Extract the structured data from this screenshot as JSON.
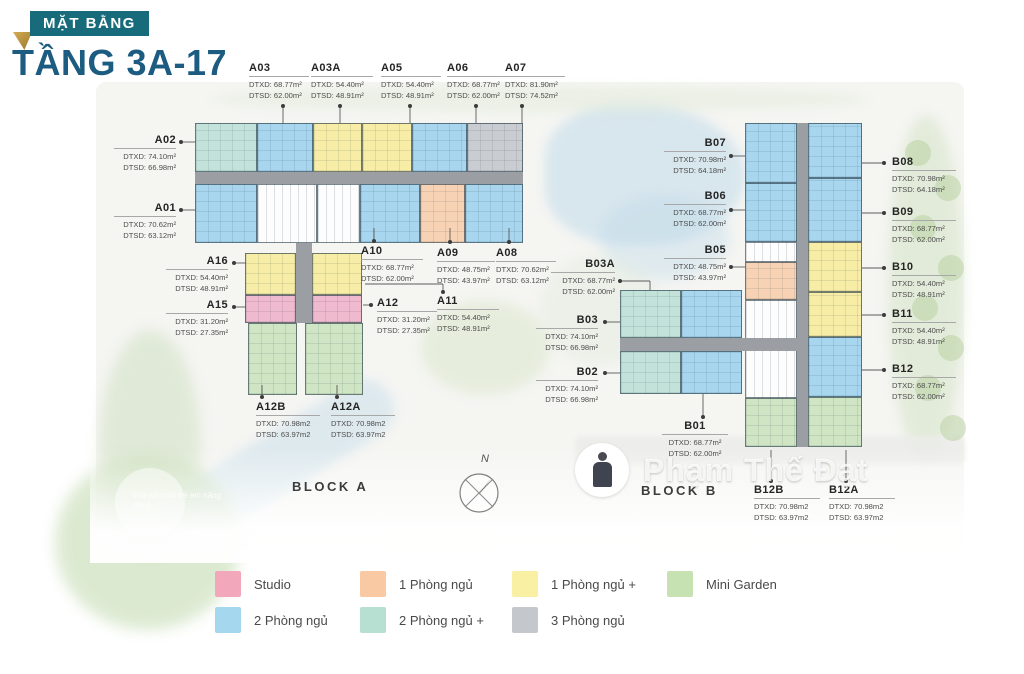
{
  "title": {
    "badge": "MẶT BẰNG",
    "heading": "TẦNG 3A-17"
  },
  "block_a_label": "BLOCK A",
  "block_b_label": "BLOCK B",
  "compass_label": "N",
  "watermark": {
    "name": "Phạm Thế Đạt"
  },
  "background_note": "khu vui chơi trẻ em năng động",
  "accent": {
    "badge_bg": "#186b7b",
    "heading_color": "#1b5c80",
    "fold_gold": "#c19b42"
  },
  "palette": {
    "blue": "#a7d6ee",
    "teal": "#c3e3da",
    "yellow": "#f7eda6",
    "peach": "#f7d2b4",
    "pink": "#efb9ce",
    "green": "#cfe5c4",
    "gray": "#c9ccd1",
    "core": "#fdfdfd",
    "corridor": "#9b9fa3"
  },
  "legend": [
    {
      "label": "Studio",
      "color": "#f2a7bb",
      "row": 0,
      "col": 0
    },
    {
      "label": "1 Phòng ngủ",
      "color": "#f9c9a4",
      "row": 0,
      "col": 1
    },
    {
      "label": "1 Phòng ngủ +",
      "color": "#f9f0a3",
      "row": 0,
      "col": 2
    },
    {
      "label": "Mini Garden",
      "color": "#c6e2b2",
      "row": 0,
      "col": 3
    },
    {
      "label": "2 Phòng ngủ",
      "color": "#a5d8ef",
      "row": 1,
      "col": 0
    },
    {
      "label": "2 Phòng ngủ +",
      "color": "#b8e0d2",
      "row": 1,
      "col": 1
    },
    {
      "label": "3 Phòng ngủ",
      "color": "#c4c7cc",
      "row": 1,
      "col": 2
    }
  ],
  "units": [
    {
      "id": "A03",
      "dtxd": "DTXD: 68.77m²",
      "dtsd": "DTSD: 62.00m²",
      "x": 249,
      "y": 62,
      "w": 60,
      "align": "left",
      "dot": [
        283,
        106
      ],
      "segs": [
        [
          283,
          106,
          283,
          123
        ]
      ]
    },
    {
      "id": "A03A",
      "dtxd": "DTXD: 54.40m²",
      "dtsd": "DTSD: 48.91m²",
      "x": 311,
      "y": 62,
      "w": 62,
      "align": "left",
      "dot": [
        340,
        106
      ],
      "segs": [
        [
          340,
          106,
          340,
          123
        ]
      ]
    },
    {
      "id": "A05",
      "dtxd": "DTXD: 54.40m²",
      "dtsd": "DTSD: 48.91m²",
      "x": 381,
      "y": 62,
      "w": 60,
      "align": "left",
      "dot": [
        410,
        106
      ],
      "segs": [
        [
          410,
          106,
          410,
          123
        ]
      ]
    },
    {
      "id": "A06",
      "dtxd": "DTXD: 68.77m²",
      "dtsd": "DTSD: 62.00m²",
      "x": 447,
      "y": 62,
      "w": 60,
      "align": "left",
      "dot": [
        476,
        106
      ],
      "segs": [
        [
          476,
          106,
          476,
          123
        ]
      ]
    },
    {
      "id": "A07",
      "dtxd": "DTXD: 81.90m²",
      "dtsd": "DTSD: 74.52m²",
      "x": 505,
      "y": 62,
      "w": 60,
      "align": "left",
      "dot": [
        522,
        106
      ],
      "segs": [
        [
          522,
          106,
          522,
          123
        ]
      ]
    },
    {
      "id": "A02",
      "dtxd": "DTXD: 74.10m²",
      "dtsd": "DTSD: 66.98m²",
      "x": 114,
      "y": 134,
      "w": 62,
      "align": "right",
      "dot": [
        181,
        142
      ],
      "segs": [
        [
          181,
          142,
          196,
          142
        ]
      ]
    },
    {
      "id": "A01",
      "dtxd": "DTXD: 70.62m²",
      "dtsd": "DTSD: 63.12m²",
      "x": 114,
      "y": 202,
      "w": 62,
      "align": "right",
      "dot": [
        181,
        210
      ],
      "segs": [
        [
          181,
          210,
          196,
          210
        ]
      ]
    },
    {
      "id": "A16",
      "dtxd": "DTXD: 54.40m²",
      "dtsd": "DTSD: 48.91m²",
      "x": 166,
      "y": 255,
      "w": 62,
      "align": "right",
      "dot": [
        234,
        263
      ],
      "segs": [
        [
          234,
          263,
          246,
          263
        ]
      ]
    },
    {
      "id": "A15",
      "dtxd": "DTXD: 31.20m²",
      "dtsd": "DTSD: 27.35m²",
      "x": 166,
      "y": 299,
      "w": 62,
      "align": "right",
      "dot": [
        234,
        307
      ],
      "segs": [
        [
          234,
          307,
          246,
          307
        ]
      ]
    },
    {
      "id": "A10",
      "dtxd": "DTXD: 68.77m²",
      "dtsd": "DTSD: 62.00m²",
      "x": 361,
      "y": 245,
      "w": 62,
      "align": "left",
      "dot": [
        374,
        241
      ],
      "segs": [
        [
          374,
          228,
          374,
          241
        ]
      ]
    },
    {
      "id": "A09",
      "dtxd": "DTXD: 48.75m²",
      "dtsd": "DTSD: 43.97m²",
      "x": 437,
      "y": 247,
      "w": 58,
      "align": "left",
      "dot": [
        450,
        242
      ],
      "segs": [
        [
          450,
          228,
          450,
          242
        ]
      ]
    },
    {
      "id": "A08",
      "dtxd": "DTXD: 70.62m²",
      "dtsd": "DTSD: 63.12m²",
      "x": 496,
      "y": 247,
      "w": 60,
      "align": "left",
      "dot": [
        509,
        242
      ],
      "segs": [
        [
          509,
          228,
          509,
          242
        ]
      ]
    },
    {
      "id": "A12",
      "dtxd": "DTXD: 31.20m²",
      "dtsd": "DTSD: 27.35m²",
      "x": 377,
      "y": 297,
      "w": 60,
      "align": "left",
      "dot": [
        371,
        305
      ],
      "segs": [
        [
          363,
          305,
          371,
          305
        ]
      ]
    },
    {
      "id": "A11",
      "dtxd": "DTXD: 54.40m²",
      "dtsd": "DTSD: 48.91m²",
      "x": 437,
      "y": 295,
      "w": 62,
      "align": "left",
      "dot": [
        443,
        292
      ],
      "segs": [
        [
          443,
          284,
          443,
          292
        ],
        [
          365,
          284,
          443,
          284
        ]
      ]
    },
    {
      "id": "A12B",
      "dtxd": "DTXD: 70.98m2",
      "dtsd": "DTSD: 63.97m2",
      "x": 256,
      "y": 401,
      "w": 64,
      "align": "left",
      "dot": [
        262,
        397
      ],
      "segs": [
        [
          262,
          385,
          262,
          397
        ]
      ]
    },
    {
      "id": "A12A",
      "dtxd": "DTXD: 70.98m2",
      "dtsd": "DTSD: 63.97m2",
      "x": 331,
      "y": 401,
      "w": 64,
      "align": "left",
      "dot": [
        337,
        397
      ],
      "segs": [
        [
          337,
          385,
          337,
          397
        ]
      ]
    },
    {
      "id": "B07",
      "dtxd": "DTXD: 70.98m²",
      "dtsd": "DTSD: 64.18m²",
      "x": 664,
      "y": 137,
      "w": 62,
      "align": "right",
      "dot": [
        731,
        156
      ],
      "segs": [
        [
          731,
          156,
          745,
          156
        ]
      ]
    },
    {
      "id": "B06",
      "dtxd": "DTXD: 68.77m²",
      "dtsd": "DTSD: 62.00m²",
      "x": 664,
      "y": 190,
      "w": 62,
      "align": "right",
      "dot": [
        731,
        210
      ],
      "segs": [
        [
          731,
          210,
          745,
          210
        ]
      ]
    },
    {
      "id": "B05",
      "dtxd": "DTXD: 48.75m²",
      "dtsd": "DTSD: 43.97m²",
      "x": 664,
      "y": 244,
      "w": 62,
      "align": "right",
      "dot": [
        731,
        267
      ],
      "segs": [
        [
          731,
          267,
          745,
          267
        ]
      ]
    },
    {
      "id": "B03A",
      "dtxd": "DTXD: 68.77m²",
      "dtsd": "DTSD: 62.00m²",
      "x": 551,
      "y": 258,
      "w": 64,
      "align": "right",
      "dot": [
        620,
        281
      ],
      "segs": [
        [
          620,
          281,
          650,
          281
        ],
        [
          650,
          281,
          650,
          290
        ]
      ]
    },
    {
      "id": "B03",
      "dtxd": "DTXD: 74.10m²",
      "dtsd": "DTSD: 66.98m²",
      "x": 536,
      "y": 314,
      "w": 62,
      "align": "right",
      "dot": [
        605,
        322
      ],
      "segs": [
        [
          605,
          322,
          620,
          322
        ]
      ]
    },
    {
      "id": "B02",
      "dtxd": "DTXD: 74.10m²",
      "dtsd": "DTSD: 66.98m²",
      "x": 536,
      "y": 366,
      "w": 62,
      "align": "right",
      "dot": [
        605,
        373
      ],
      "segs": [
        [
          605,
          373,
          620,
          373
        ]
      ]
    },
    {
      "id": "B01",
      "dtxd": "DTXD: 68.77m²",
      "dtsd": "DTSD: 62.00m²",
      "x": 662,
      "y": 420,
      "w": 66,
      "align": "center",
      "dot": [
        703,
        417
      ],
      "segs": [
        [
          703,
          394,
          703,
          417
        ]
      ]
    },
    {
      "id": "B08",
      "dtxd": "DTXD: 70.98m²",
      "dtsd": "DTSD: 64.18m²",
      "x": 892,
      "y": 156,
      "w": 64,
      "align": "left",
      "dot": [
        884,
        163
      ],
      "segs": [
        [
          862,
          163,
          884,
          163
        ]
      ]
    },
    {
      "id": "B09",
      "dtxd": "DTXD: 68.77m²",
      "dtsd": "DTSD: 62.00m²",
      "x": 892,
      "y": 206,
      "w": 64,
      "align": "left",
      "dot": [
        884,
        213
      ],
      "segs": [
        [
          862,
          213,
          884,
          213
        ]
      ]
    },
    {
      "id": "B10",
      "dtxd": "DTXD: 54.40m²",
      "dtsd": "DTSD: 48.91m²",
      "x": 892,
      "y": 261,
      "w": 64,
      "align": "left",
      "dot": [
        884,
        268
      ],
      "segs": [
        [
          862,
          268,
          884,
          268
        ]
      ]
    },
    {
      "id": "B11",
      "dtxd": "DTXD: 54.40m²",
      "dtsd": "DTSD: 48.91m²",
      "x": 892,
      "y": 308,
      "w": 64,
      "align": "left",
      "dot": [
        884,
        315
      ],
      "segs": [
        [
          862,
          315,
          884,
          315
        ]
      ]
    },
    {
      "id": "B12",
      "dtxd": "DTXD: 68.77m²",
      "dtsd": "DTSD: 62.00m²",
      "x": 892,
      "y": 363,
      "w": 64,
      "align": "left",
      "dot": [
        884,
        370
      ],
      "segs": [
        [
          862,
          370,
          884,
          370
        ]
      ]
    },
    {
      "id": "B12B",
      "dtxd": "DTXD: 70.98m2",
      "dtsd": "DTSD: 63.97m2",
      "x": 754,
      "y": 484,
      "w": 66,
      "align": "left",
      "dot": [
        771,
        481
      ],
      "segs": [
        [
          771,
          450,
          771,
          481
        ]
      ]
    },
    {
      "id": "B12A",
      "dtxd": "DTXD: 70.98m2",
      "dtsd": "DTSD: 63.97m2",
      "x": 829,
      "y": 484,
      "w": 66,
      "align": "left",
      "dot": [
        846,
        481
      ],
      "segs": [
        [
          846,
          450,
          846,
          481
        ]
      ]
    }
  ],
  "shapes": [
    {
      "x": 195,
      "y": 123,
      "w": 62,
      "h": 49,
      "c": "teal"
    },
    {
      "x": 257,
      "y": 123,
      "w": 56,
      "h": 49,
      "c": "blue"
    },
    {
      "x": 313,
      "y": 123,
      "w": 49,
      "h": 49,
      "c": "yellow"
    },
    {
      "x": 362,
      "y": 123,
      "w": 50,
      "h": 49,
      "c": "yellow"
    },
    {
      "x": 412,
      "y": 123,
      "w": 55,
      "h": 49,
      "c": "blue"
    },
    {
      "x": 467,
      "y": 123,
      "w": 56,
      "h": 49,
      "c": "gray"
    },
    {
      "x": 195,
      "y": 172,
      "w": 328,
      "h": 12,
      "c": "corridor"
    },
    {
      "x": 195,
      "y": 184,
      "w": 62,
      "h": 59,
      "c": "blue"
    },
    {
      "x": 257,
      "y": 184,
      "w": 60,
      "h": 59,
      "c": "core"
    },
    {
      "x": 317,
      "y": 184,
      "w": 43,
      "h": 59,
      "c": "core"
    },
    {
      "x": 360,
      "y": 184,
      "w": 60,
      "h": 59,
      "c": "blue"
    },
    {
      "x": 420,
      "y": 184,
      "w": 45,
      "h": 59,
      "c": "peach"
    },
    {
      "x": 465,
      "y": 184,
      "w": 58,
      "h": 59,
      "c": "blue"
    },
    {
      "x": 296,
      "y": 243,
      "w": 16,
      "h": 80,
      "c": "corridor"
    },
    {
      "x": 245,
      "y": 253,
      "w": 51,
      "h": 42,
      "c": "yellow"
    },
    {
      "x": 312,
      "y": 253,
      "w": 50,
      "h": 42,
      "c": "yellow"
    },
    {
      "x": 245,
      "y": 295,
      "w": 51,
      "h": 28,
      "c": "pink"
    },
    {
      "x": 312,
      "y": 295,
      "w": 50,
      "h": 28,
      "c": "pink"
    },
    {
      "x": 248,
      "y": 323,
      "w": 49,
      "h": 72,
      "c": "green"
    },
    {
      "x": 305,
      "y": 323,
      "w": 58,
      "h": 72,
      "c": "green"
    },
    {
      "x": 797,
      "y": 123,
      "w": 11,
      "h": 324,
      "c": "corridor"
    },
    {
      "x": 745,
      "y": 123,
      "w": 52,
      "h": 60,
      "c": "blue"
    },
    {
      "x": 745,
      "y": 183,
      "w": 52,
      "h": 59,
      "c": "blue"
    },
    {
      "x": 745,
      "y": 242,
      "w": 52,
      "h": 20,
      "c": "core"
    },
    {
      "x": 745,
      "y": 262,
      "w": 52,
      "h": 38,
      "c": "peach"
    },
    {
      "x": 745,
      "y": 300,
      "w": 52,
      "h": 48,
      "c": "core"
    },
    {
      "x": 745,
      "y": 348,
      "w": 52,
      "h": 50,
      "c": "core"
    },
    {
      "x": 745,
      "y": 398,
      "w": 52,
      "h": 49,
      "c": "green"
    },
    {
      "x": 808,
      "y": 123,
      "w": 54,
      "h": 55,
      "c": "blue"
    },
    {
      "x": 808,
      "y": 178,
      "w": 54,
      "h": 64,
      "c": "blue"
    },
    {
      "x": 808,
      "y": 242,
      "w": 54,
      "h": 50,
      "c": "yellow"
    },
    {
      "x": 808,
      "y": 292,
      "w": 54,
      "h": 45,
      "c": "yellow"
    },
    {
      "x": 808,
      "y": 337,
      "w": 54,
      "h": 60,
      "c": "blue"
    },
    {
      "x": 808,
      "y": 397,
      "w": 54,
      "h": 50,
      "c": "green"
    },
    {
      "x": 620,
      "y": 290,
      "w": 61,
      "h": 48,
      "c": "teal"
    },
    {
      "x": 681,
      "y": 290,
      "w": 61,
      "h": 48,
      "c": "blue"
    },
    {
      "x": 620,
      "y": 338,
      "w": 177,
      "h": 13,
      "c": "corridor"
    },
    {
      "x": 620,
      "y": 351,
      "w": 61,
      "h": 43,
      "c": "teal"
    },
    {
      "x": 681,
      "y": 351,
      "w": 61,
      "h": 43,
      "c": "blue"
    }
  ]
}
